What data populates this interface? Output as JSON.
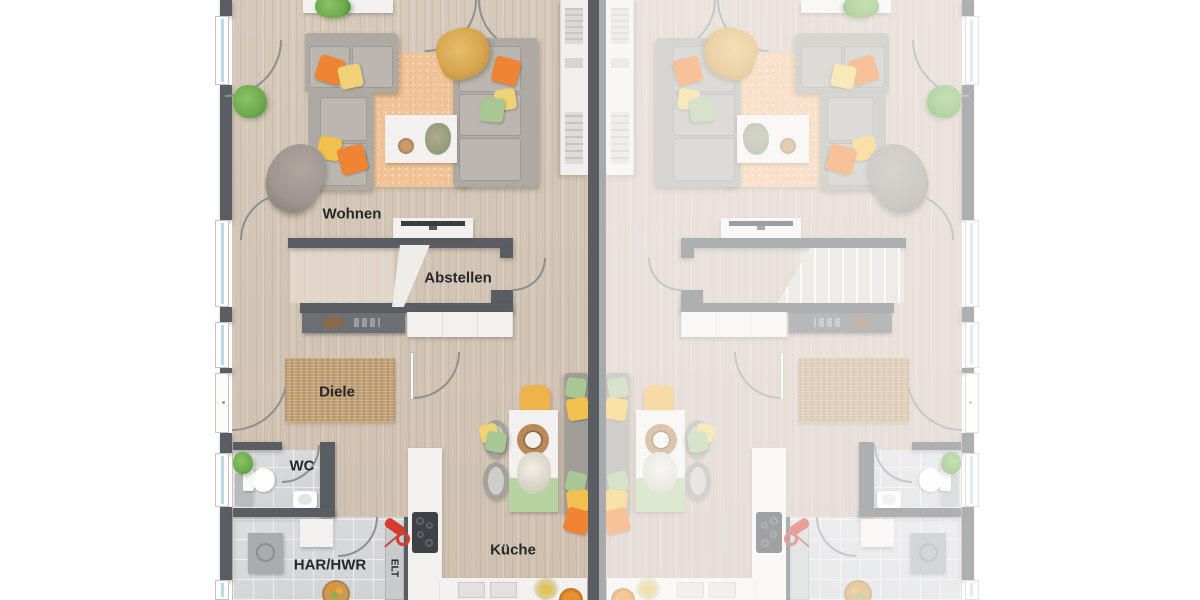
{
  "rooms": {
    "wohnen": "Wohnen",
    "abstellen": "Abstellen",
    "diele": "Diele",
    "wc": "WC",
    "har_hwr": "HAR/HWR",
    "elt": "ELT",
    "kueche": "Küche"
  },
  "colors": {
    "wall": "#5a5e62",
    "wall_light": "#a7abae",
    "floor_wood": "#d3c5b6",
    "floor_tile": "#d7d8d9",
    "rug_living": "#f2c396",
    "rug_jute": "#c2a176",
    "counter": "#f2f1ef",
    "sofa": "#aeaaa3",
    "pillow_orange": "#ee8434",
    "pillow_yellow": "#f2c04e",
    "pillow_green": "#a9c795",
    "blanket_mustard": "#d7a64f",
    "blanket_gray": "#9c968e",
    "chair_yellow": "#eeb44c",
    "runner_green": "#b8d3a2",
    "plant_green": "#69a84a",
    "appliance_gray": "#a9abad",
    "vacuum_red": "#d63a30",
    "window_glass": "#bcd9e8",
    "label_ink": "#26282b"
  }
}
